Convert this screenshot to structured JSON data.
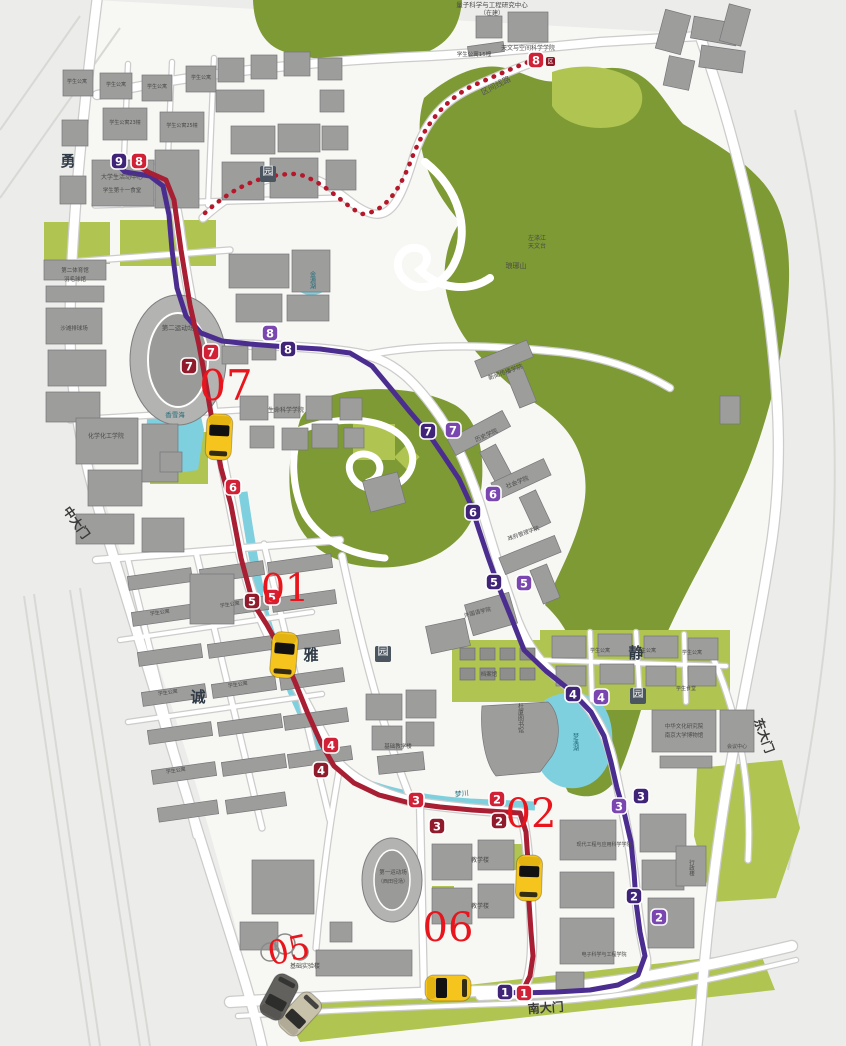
{
  "map": {
    "accent_colors": {
      "red_line": "#a81e32",
      "purple_line": "#4a2d8f",
      "section_line": "#b5182b",
      "taxi_yellow": "#f6c51d",
      "order_number_red": "#e8151d",
      "park_green": "#7d9a34",
      "lawn_green": "#b0c452",
      "water_cyan": "#7fd0df"
    },
    "routes": {
      "red": {
        "name": "red-campus-bus-line",
        "color": "#a81e32",
        "badge_colors": [
          "#8f1b2c",
          "#d02136"
        ],
        "points": "139,166 148,172 166,180 174,200 181,250 190,305 199,345 204,372 212,420 221,468 231,505 241,558 253,603 267,625 282,652 295,682 308,714 321,743 334,766 354,783 379,795 410,803 440,807 472,810 505,812 520,813 526,832 528,862 529,902 531,932 533,956 530,976 524,988",
        "stops": [
          {
            "n": "8",
            "x": 139,
            "y": 161,
            "s": 1
          },
          {
            "n": "7",
            "x": 189,
            "y": 366,
            "s": 0
          },
          {
            "n": "7",
            "x": 211,
            "y": 352,
            "s": 1
          },
          {
            "n": "6",
            "x": 233,
            "y": 487,
            "s": 1
          },
          {
            "n": "5",
            "x": 252,
            "y": 601,
            "s": 0
          },
          {
            "n": "5",
            "x": 272,
            "y": 597,
            "s": 1
          },
          {
            "n": "4",
            "x": 331,
            "y": 745,
            "s": 1
          },
          {
            "n": "4",
            "x": 321,
            "y": 770,
            "s": 0
          },
          {
            "n": "3",
            "x": 416,
            "y": 800,
            "s": 1
          },
          {
            "n": "3",
            "x": 437,
            "y": 826,
            "s": 0
          },
          {
            "n": "2",
            "x": 497,
            "y": 799,
            "s": 1
          },
          {
            "n": "2",
            "x": 499,
            "y": 821,
            "s": 0
          },
          {
            "n": "1",
            "x": 524,
            "y": 993,
            "s": 1
          },
          {
            "n": "8",
            "x": 536,
            "y": 60,
            "s": 1,
            "tag": "区"
          }
        ]
      },
      "purple": {
        "name": "purple-campus-bus-line",
        "color": "#4a2d8f",
        "badge_colors": [
          "#3f2478",
          "#7a47b0"
        ],
        "points": "119,166 125,172 150,176 163,186 169,215 172,250 177,288 186,316 201,333 222,341 250,344 287,347 320,349 350,353 372,366 392,390 410,412 428,433 443,455 459,479 471,505 479,530 488,557 498,585 511,617 524,650 546,671 571,691 591,712 604,736 611,762 617,788 624,812 631,842 634,872 636,902 640,932 645,956 638,975 618,985 590,990 556,992 520,993 507,992",
        "stops": [
          {
            "n": "9",
            "x": 119,
            "y": 161,
            "s": 0
          },
          {
            "n": "8",
            "x": 270,
            "y": 333,
            "s": 1
          },
          {
            "n": "8",
            "x": 288,
            "y": 349,
            "s": 0
          },
          {
            "n": "7",
            "x": 428,
            "y": 431,
            "s": 0
          },
          {
            "n": "7",
            "x": 453,
            "y": 430,
            "s": 1
          },
          {
            "n": "6",
            "x": 473,
            "y": 512,
            "s": 0
          },
          {
            "n": "6",
            "x": 493,
            "y": 494,
            "s": 1
          },
          {
            "n": "5",
            "x": 494,
            "y": 582,
            "s": 0
          },
          {
            "n": "5",
            "x": 524,
            "y": 583,
            "s": 1
          },
          {
            "n": "4",
            "x": 573,
            "y": 694,
            "s": 0
          },
          {
            "n": "4",
            "x": 601,
            "y": 697,
            "s": 1
          },
          {
            "n": "3",
            "x": 619,
            "y": 806,
            "s": 1
          },
          {
            "n": "3",
            "x": 641,
            "y": 796,
            "s": 0
          },
          {
            "n": "2",
            "x": 634,
            "y": 896,
            "s": 0
          },
          {
            "n": "2",
            "x": 659,
            "y": 917,
            "s": 1
          },
          {
            "n": "1",
            "x": 505,
            "y": 992,
            "s": 0
          }
        ]
      },
      "section": {
        "name": "section-shuttle-line",
        "label": "区间线路",
        "label_x": 497,
        "label_y": 88,
        "label_rot": -27,
        "color": "#b5182b",
        "terminal_tag": "区",
        "points": "M205,213 C232,188 262,173 298,174 C326,182 344,206 362,214 C381,213 397,196 410,163 C425,122 446,100 472,86 C500,74 522,64 534,60"
      }
    },
    "vehicles": {
      "taxis": [
        {
          "id": "taxi-07",
          "x": 219,
          "y": 437,
          "rot": 3
        },
        {
          "id": "taxi-01",
          "x": 284,
          "y": 655,
          "rot": 5
        },
        {
          "id": "taxi-02",
          "x": 529,
          "y": 878,
          "rot": 2
        },
        {
          "id": "taxi-06",
          "x": 448,
          "y": 988,
          "rot": -90
        }
      ],
      "other_cars": [
        {
          "id": "car-beige",
          "x": 300,
          "y": 1014,
          "rot": -137,
          "fill": "#c9c2ab"
        },
        {
          "id": "car-dark",
          "x": 279,
          "y": 997,
          "rot": -152,
          "fill": "#62615e"
        }
      ],
      "order_labels": [
        {
          "id": "07",
          "x": 226,
          "y": 400,
          "size": 42
        },
        {
          "id": "01",
          "x": 285,
          "y": 601,
          "size": 38
        },
        {
          "id": "02",
          "x": 531,
          "y": 827,
          "size": 40
        },
        {
          "id": "06",
          "x": 448,
          "y": 941,
          "size": 40
        },
        {
          "id": "05",
          "x": 291,
          "y": 961,
          "size": 33,
          "rot": -12
        }
      ]
    },
    "gates": [
      {
        "text": "中大门",
        "x": 73,
        "y": 525,
        "rot": 55
      },
      {
        "text": "东大门",
        "x": 760,
        "y": 737,
        "rot": 70
      },
      {
        "text": "南大门",
        "x": 546,
        "y": 1012,
        "rot": -4
      }
    ],
    "zone_labels": [
      {
        "text": "勇",
        "x": 68,
        "y": 166
      },
      {
        "text": "诚",
        "x": 198,
        "y": 702
      },
      {
        "text": "雅",
        "x": 311,
        "y": 660
      },
      {
        "text": "静",
        "x": 636,
        "y": 658
      }
    ],
    "boxed_labels": [
      {
        "text": "园",
        "x": 268,
        "y": 178
      },
      {
        "text": "园",
        "x": 383,
        "y": 658
      },
      {
        "text": "园",
        "x": 638,
        "y": 700
      }
    ],
    "water_labels": [
      {
        "t": "香雪海",
        "x": 175,
        "y": 417,
        "s": 6.5
      },
      {
        "t": "金源湖",
        "x": 312,
        "y": 280,
        "s": 6,
        "v": true
      },
      {
        "t": "梦川",
        "x": 462,
        "y": 796,
        "s": 7,
        "r": -6
      },
      {
        "t": "梦溪湖",
        "x": 575,
        "y": 742,
        "s": 6,
        "v": true
      }
    ],
    "place_labels": [
      {
        "t": "量子科学与工程研究中心",
        "x": 492,
        "y": 7,
        "s": 6.5
      },
      {
        "t": "（在建）",
        "x": 492,
        "y": 15,
        "s": 6
      },
      {
        "t": "学生公寓15幢",
        "x": 474,
        "y": 56,
        "s": 5.5
      },
      {
        "t": "天文与空间科学学院",
        "x": 528,
        "y": 50,
        "s": 6
      },
      {
        "t": "学生公寓",
        "x": 77,
        "y": 83,
        "s": 5
      },
      {
        "t": "学生公寓",
        "x": 116,
        "y": 86,
        "s": 5
      },
      {
        "t": "学生公寓",
        "x": 157,
        "y": 88,
        "s": 5
      },
      {
        "t": "学生公寓",
        "x": 201,
        "y": 79,
        "s": 5
      },
      {
        "t": "学生公寓23幢",
        "x": 125,
        "y": 124,
        "s": 5
      },
      {
        "t": "学生公寓25幢",
        "x": 182,
        "y": 127,
        "s": 5
      },
      {
        "t": "大学生活动中心",
        "x": 122,
        "y": 179,
        "s": 6
      },
      {
        "t": "学生第十一食堂",
        "x": 122,
        "y": 192,
        "s": 5.5
      },
      {
        "t": "第二体育馆",
        "x": 75,
        "y": 272,
        "s": 5.5
      },
      {
        "t": "羽毛球馆",
        "x": 75,
        "y": 281,
        "s": 5.5
      },
      {
        "t": "沙滩排球场",
        "x": 74,
        "y": 330,
        "s": 5.5
      },
      {
        "t": "第二运动场",
        "x": 178,
        "y": 330,
        "s": 6.5
      },
      {
        "t": "化学化工学院",
        "x": 106,
        "y": 438,
        "s": 6
      },
      {
        "t": "生命科学学院",
        "x": 286,
        "y": 412,
        "s": 6
      },
      {
        "t": "左涤江",
        "x": 537,
        "y": 240,
        "s": 6
      },
      {
        "t": "天文台",
        "x": 537,
        "y": 248,
        "s": 6
      },
      {
        "t": "琅琊山",
        "x": 516,
        "y": 268,
        "s": 7
      },
      {
        "t": "新闻传播学院",
        "x": 506,
        "y": 374,
        "s": 6,
        "r": -20
      },
      {
        "t": "历史学院",
        "x": 487,
        "y": 437,
        "s": 6,
        "r": -24
      },
      {
        "t": "社会学院",
        "x": 518,
        "y": 484,
        "s": 6,
        "r": -22
      },
      {
        "t": "政府管理学院",
        "x": 524,
        "y": 535,
        "s": 5.5,
        "r": -20
      },
      {
        "t": "外国语学院",
        "x": 478,
        "y": 614,
        "s": 5.5,
        "r": -14
      },
      {
        "t": "档案馆",
        "x": 489,
        "y": 676,
        "s": 5.5
      },
      {
        "t": "杜厦图书馆",
        "x": 520,
        "y": 718,
        "s": 6,
        "v": true
      },
      {
        "t": "中华文化研究院",
        "x": 684,
        "y": 728,
        "s": 5.5
      },
      {
        "t": "南京大学博物馆",
        "x": 684,
        "y": 737,
        "s": 5.5
      },
      {
        "t": "会议中心",
        "x": 737,
        "y": 748,
        "s": 5
      },
      {
        "t": "学生公寓",
        "x": 600,
        "y": 652,
        "s": 5
      },
      {
        "t": "学生公寓",
        "x": 646,
        "y": 652,
        "s": 5
      },
      {
        "t": "学生公寓",
        "x": 692,
        "y": 654,
        "s": 5
      },
      {
        "t": "学生食堂",
        "x": 686,
        "y": 690,
        "s": 5
      },
      {
        "t": "现代工程与应用科学学院",
        "x": 604,
        "y": 846,
        "s": 5
      },
      {
        "t": "电子科学与工程学院",
        "x": 604,
        "y": 956,
        "s": 5
      },
      {
        "t": "行政楼",
        "x": 691,
        "y": 868,
        "s": 5.5,
        "v": true
      },
      {
        "t": "教学楼",
        "x": 480,
        "y": 862,
        "s": 6
      },
      {
        "t": "教学楼",
        "x": 480,
        "y": 908,
        "s": 6
      },
      {
        "t": "第一运动场",
        "x": 393,
        "y": 874,
        "s": 5.5
      },
      {
        "t": "（西田径场）",
        "x": 393,
        "y": 883,
        "s": 5
      },
      {
        "t": "基础实验楼",
        "x": 305,
        "y": 968,
        "s": 6
      },
      {
        "t": "基础教学楼",
        "x": 398,
        "y": 748,
        "s": 5.5
      },
      {
        "t": "学生公寓",
        "x": 160,
        "y": 614,
        "s": 5,
        "r": -8
      },
      {
        "t": "学生公寓",
        "x": 230,
        "y": 606,
        "s": 5,
        "r": -8
      },
      {
        "t": "学生公寓",
        "x": 168,
        "y": 694,
        "s": 5,
        "r": -8
      },
      {
        "t": "学生公寓",
        "x": 238,
        "y": 686,
        "s": 5,
        "r": -8
      },
      {
        "t": "学生公寓",
        "x": 176,
        "y": 772,
        "s": 5,
        "r": -8
      }
    ]
  }
}
